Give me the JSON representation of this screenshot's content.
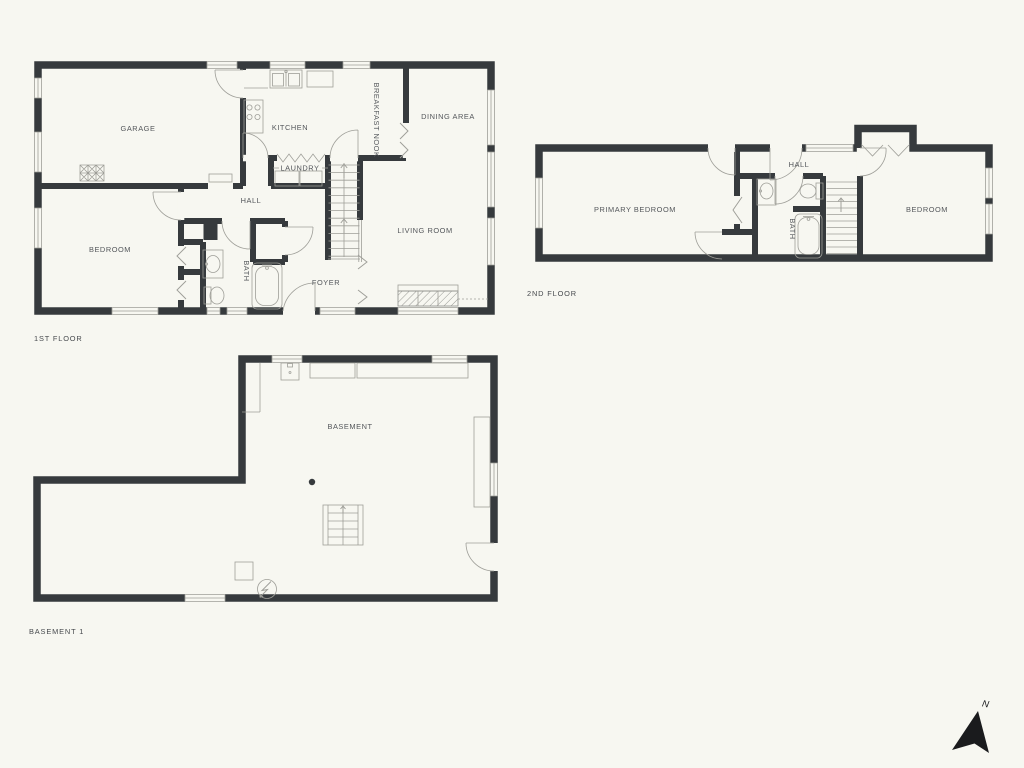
{
  "floors": {
    "first": {
      "caption": "1ST FLOOR",
      "rooms": {
        "garage": "GARAGE",
        "kitchen": "KITCHEN",
        "breakfast_nook": "BREAKFAST NOOK",
        "dining": "DINING AREA",
        "laundry": "LAUNDRY",
        "hall": "HALL",
        "bedroom": "BEDROOM",
        "bath": "BATH",
        "foyer": "FOYER",
        "living": "LIVING ROOM"
      }
    },
    "second": {
      "caption": "2ND FLOOR",
      "rooms": {
        "primary": "PRIMARY BEDROOM",
        "hall": "HALL",
        "bath": "BATH",
        "bedroom": "BEDROOM"
      }
    },
    "basement": {
      "caption": "BASEMENT 1",
      "rooms": {
        "main": "BASEMENT"
      }
    }
  },
  "compass": {
    "north": "N"
  },
  "colors": {
    "wall": "#363a3d",
    "line": "#9e9e98",
    "text": "#54575b",
    "background": "#f7f7f1"
  }
}
